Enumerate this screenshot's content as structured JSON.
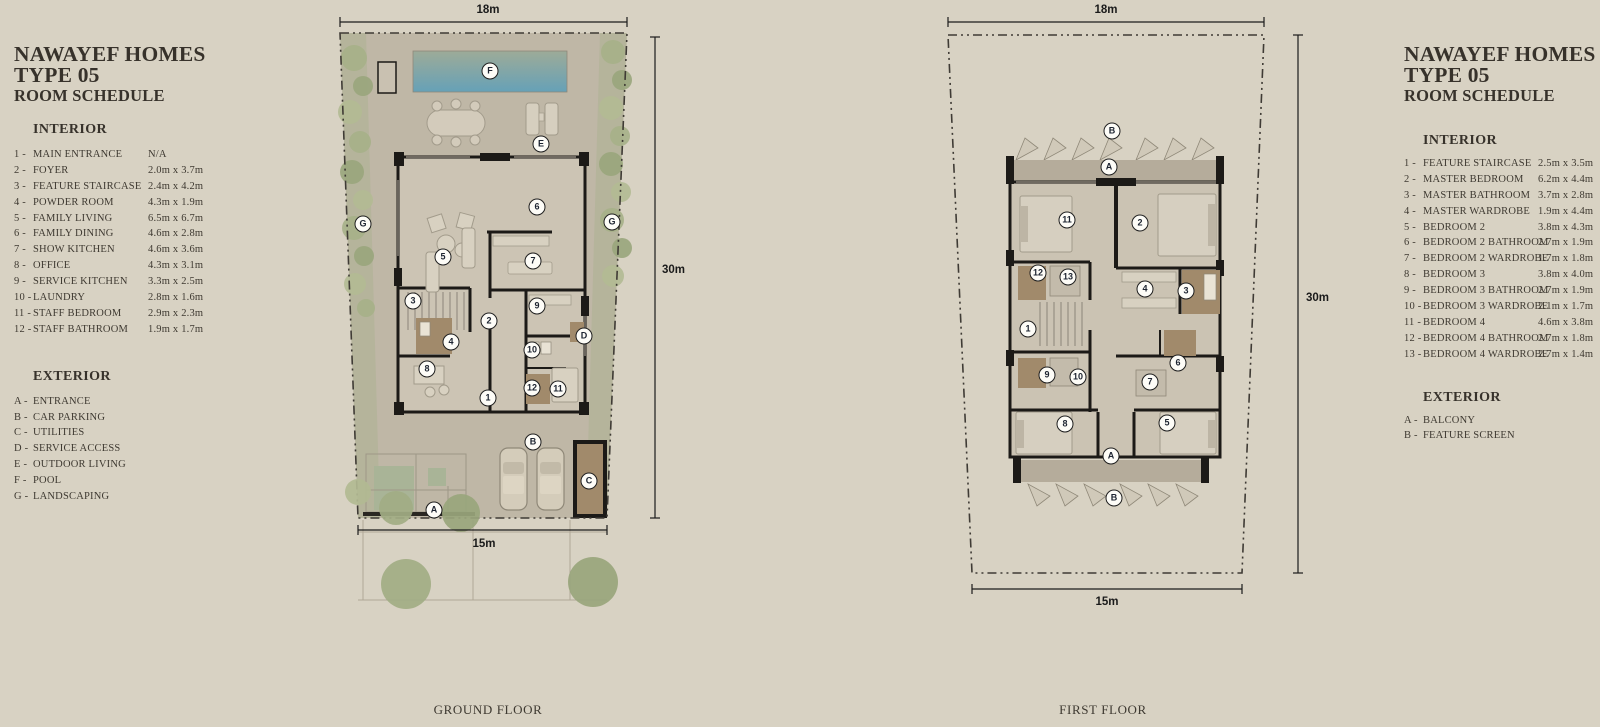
{
  "colors": {
    "page_background": "#d8d2c3",
    "ink": "#3e3931",
    "wall": "#1c1a17",
    "pool_top": "#9dab98",
    "pool_bottom": "#66a1b7",
    "landscaping_green": "#a6b088",
    "bathroom_brown": "#a18a6b",
    "deck": "#bfb7a6",
    "interior_floor": "#ccc4b4"
  },
  "left_panel": {
    "title1": "NAWAYEF HOMES",
    "title2": "TYPE 05",
    "title3": "ROOM SCHEDULE",
    "interior": {
      "heading": "INTERIOR",
      "items": [
        {
          "num": "1 -",
          "name": "MAIN ENTRANCE",
          "dim": "N/A"
        },
        {
          "num": "2 -",
          "name": "FOYER",
          "dim": "2.0m x 3.7m"
        },
        {
          "num": "3 -",
          "name": "FEATURE STAIRCASE",
          "dim": "2.4m x 4.2m"
        },
        {
          "num": "4 -",
          "name": "POWDER ROOM",
          "dim": "4.3m x 1.9m"
        },
        {
          "num": "5 -",
          "name": "FAMILY LIVING",
          "dim": "6.5m x 6.7m"
        },
        {
          "num": "6 -",
          "name": "FAMILY DINING",
          "dim": "4.6m x 2.8m"
        },
        {
          "num": "7 -",
          "name": "SHOW KITCHEN",
          "dim": "4.6m x 3.6m"
        },
        {
          "num": "8 -",
          "name": "OFFICE",
          "dim": "4.3m x 3.1m"
        },
        {
          "num": "9 -",
          "name": "SERVICE KITCHEN",
          "dim": "3.3m x 2.5m"
        },
        {
          "num": "10 -",
          "name": "LAUNDRY",
          "dim": "2.8m x 1.6m"
        },
        {
          "num": "11 -",
          "name": "STAFF BEDROOM",
          "dim": "2.9m x 2.3m"
        },
        {
          "num": "12 -",
          "name": "STAFF BATHROOM",
          "dim": "1.9m x 1.7m"
        }
      ]
    },
    "exterior": {
      "heading": "EXTERIOR",
      "items": [
        {
          "num": "A -",
          "name": "ENTRANCE"
        },
        {
          "num": "B -",
          "name": "CAR PARKING"
        },
        {
          "num": "C -",
          "name": "UTILITIES"
        },
        {
          "num": "D -",
          "name": "SERVICE ACCESS"
        },
        {
          "num": "E -",
          "name": "OUTDOOR LIVING"
        },
        {
          "num": "F -",
          "name": "POOL"
        },
        {
          "num": "G -",
          "name": "LANDSCAPING"
        }
      ]
    }
  },
  "right_panel": {
    "title1": "NAWAYEF HOMES",
    "title2": "TYPE 05",
    "title3": "ROOM SCHEDULE",
    "interior": {
      "heading": "INTERIOR",
      "items": [
        {
          "num": "1 -",
          "name": "FEATURE STAIRCASE",
          "dim": "2.5m x 3.5m"
        },
        {
          "num": "2 -",
          "name": "MASTER BEDROOM",
          "dim": "6.2m x 4.4m"
        },
        {
          "num": "3 -",
          "name": "MASTER BATHROOM",
          "dim": "3.7m x 2.8m"
        },
        {
          "num": "4 -",
          "name": "MASTER WARDROBE",
          "dim": "1.9m x 4.4m"
        },
        {
          "num": "5 -",
          "name": "BEDROOM 2",
          "dim": "3.8m x 4.3m"
        },
        {
          "num": "6 -",
          "name": "BEDROOM 2 BATHROOM",
          "dim": "2.7m x 1.9m"
        },
        {
          "num": "7 -",
          "name": "BEDROOM 2 WARDROBE",
          "dim": "1.7m x 1.8m"
        },
        {
          "num": "8 -",
          "name": "BEDROOM 3",
          "dim": "3.8m x 4.0m"
        },
        {
          "num": "9 -",
          "name": "BEDROOM 3 BATHROOM",
          "dim": "2.7m x 1.9m"
        },
        {
          "num": "10 -",
          "name": "BEDROOM 3 WARDROBE",
          "dim": "2.1m x 1.7m"
        },
        {
          "num": "11 -",
          "name": "BEDROOM 4",
          "dim": "4.6m x 3.8m"
        },
        {
          "num": "12 -",
          "name": "BEDROOM 4 BATHROOM",
          "dim": "2.7m x 1.8m"
        },
        {
          "num": "13 -",
          "name": "BEDROOM 4 WARDROBE",
          "dim": "2.7m x 1.4m"
        }
      ]
    },
    "exterior": {
      "heading": "EXTERIOR",
      "items": [
        {
          "num": "A -",
          "name": "BALCONY"
        },
        {
          "num": "B -",
          "name": "FEATURE SCREEN"
        }
      ]
    }
  },
  "ground_floor": {
    "label": "GROUND FLOOR",
    "dim_top": "18m",
    "dim_right": "30m",
    "dim_bottom": "15m",
    "markers": [
      {
        "label": "F",
        "x": 160,
        "y": 71
      },
      {
        "label": "E",
        "x": 211,
        "y": 144
      },
      {
        "label": "6",
        "x": 207,
        "y": 207
      },
      {
        "label": "G",
        "x": 33,
        "y": 224
      },
      {
        "label": "G",
        "x": 282,
        "y": 222
      },
      {
        "label": "5",
        "x": 113,
        "y": 257
      },
      {
        "label": "7",
        "x": 203,
        "y": 261
      },
      {
        "label": "3",
        "x": 83,
        "y": 301
      },
      {
        "label": "9",
        "x": 207,
        "y": 306
      },
      {
        "label": "2",
        "x": 159,
        "y": 321
      },
      {
        "label": "D",
        "x": 254,
        "y": 336
      },
      {
        "label": "4",
        "x": 121,
        "y": 342
      },
      {
        "label": "10",
        "x": 202,
        "y": 350
      },
      {
        "label": "8",
        "x": 97,
        "y": 369
      },
      {
        "label": "12",
        "x": 202,
        "y": 388
      },
      {
        "label": "11",
        "x": 228,
        "y": 389
      },
      {
        "label": "1",
        "x": 158,
        "y": 398
      },
      {
        "label": "B",
        "x": 203,
        "y": 442
      },
      {
        "label": "C",
        "x": 259,
        "y": 481
      },
      {
        "label": "A",
        "x": 104,
        "y": 510
      }
    ]
  },
  "first_floor": {
    "label": "FIRST FLOOR",
    "dim_top": "18m",
    "dim_right": "30m",
    "dim_bottom": "15m",
    "markers": [
      {
        "label": "B",
        "x": 192,
        "y": 131
      },
      {
        "label": "A",
        "x": 189,
        "y": 167
      },
      {
        "label": "11",
        "x": 147,
        "y": 220
      },
      {
        "label": "2",
        "x": 220,
        "y": 223
      },
      {
        "label": "12",
        "x": 118,
        "y": 273
      },
      {
        "label": "13",
        "x": 148,
        "y": 277
      },
      {
        "label": "4",
        "x": 225,
        "y": 289
      },
      {
        "label": "3",
        "x": 266,
        "y": 291
      },
      {
        "label": "1",
        "x": 108,
        "y": 329
      },
      {
        "label": "6",
        "x": 258,
        "y": 363
      },
      {
        "label": "9",
        "x": 127,
        "y": 375
      },
      {
        "label": "10",
        "x": 158,
        "y": 377
      },
      {
        "label": "7",
        "x": 230,
        "y": 382
      },
      {
        "label": "8",
        "x": 145,
        "y": 424
      },
      {
        "label": "5",
        "x": 247,
        "y": 423
      },
      {
        "label": "A",
        "x": 191,
        "y": 456
      },
      {
        "label": "B",
        "x": 194,
        "y": 498
      }
    ]
  }
}
